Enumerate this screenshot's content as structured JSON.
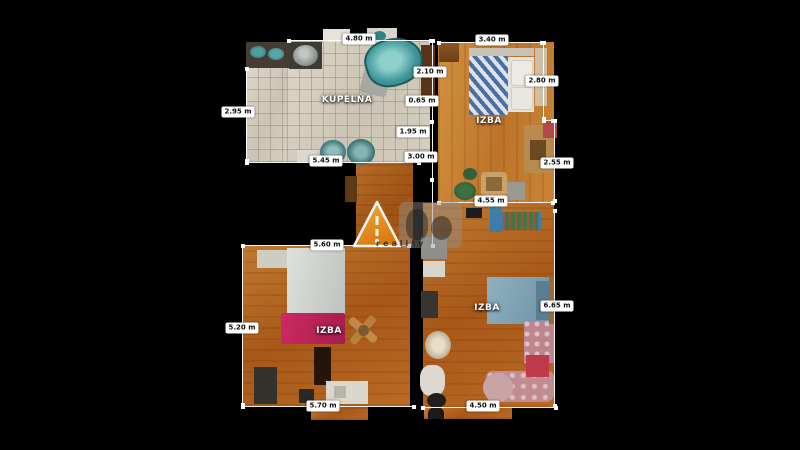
{
  "app": {
    "type": "floorplan-viewer",
    "background": "#000000"
  },
  "rooms": {
    "bathroom": {
      "name": "KÚPEĽŇA"
    },
    "bedroom_top_right": {
      "name": "IZBA"
    },
    "bedroom_bottom_left": {
      "name": "IZBA"
    },
    "bedroom_bottom_right": {
      "name": "IZBA"
    }
  },
  "measurements": {
    "bathroom_top": "4.80 m",
    "bathroom_left": "2.95 m",
    "bathroom_bottom": "5.45 m",
    "middle_segment_1": "2.10 m",
    "middle_segment_2": "0.65 m",
    "middle_segment_3": "1.95 m",
    "middle_segment_4": "3.00 m",
    "top_right_top": "3.40 m",
    "top_right_right_upper": "2.80 m",
    "top_right_right_lower": "2.55 m",
    "top_right_bottom": "4.55 m",
    "bottom_left_top": "5.60 m",
    "bottom_left_left": "5.20 m",
    "bottom_left_bottom": "5.70 m",
    "bottom_right_right": "6.65 m",
    "bottom_right_bottom": "4.50 m"
  },
  "watermark": {
    "reality_text": "reality"
  },
  "colors": {
    "background": "#000000",
    "wood_light": "#c98a3e",
    "wood_dark": "#a85818",
    "tile": "#d2cabc",
    "bathtub_teal": "#3f9598",
    "accent_magenta": "#c2255e",
    "watermark_orange": "#f08a1d",
    "measure_chip_bg": "#ffffff",
    "measure_chip_text": "#111111"
  }
}
